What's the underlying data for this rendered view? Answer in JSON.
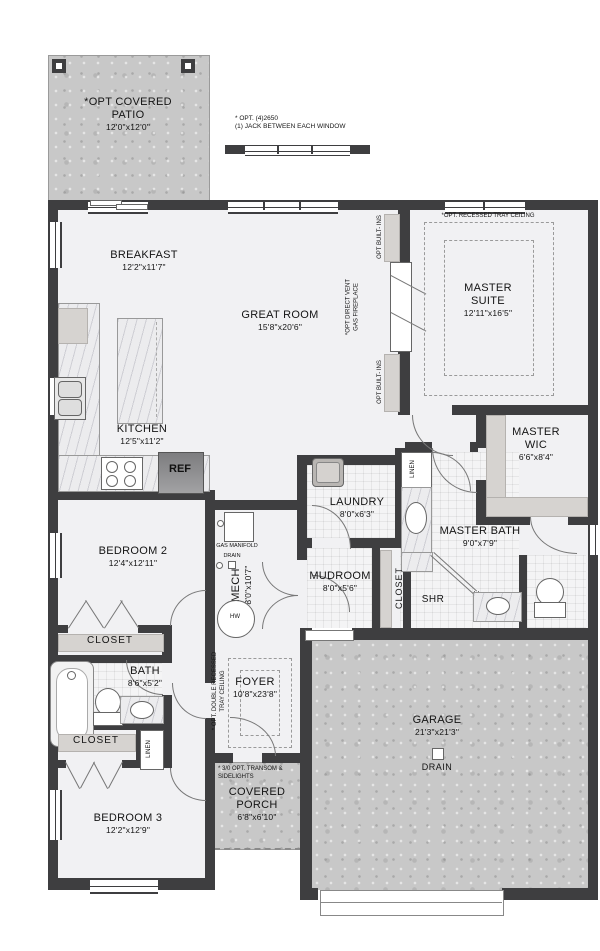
{
  "rooms": {
    "patio": {
      "name": "*OPT COVERED PATIO",
      "dims": "12'0\"x12'0\""
    },
    "breakfast": {
      "name": "BREAKFAST",
      "dims": "12'2\"x11'7\""
    },
    "great_room": {
      "name": "GREAT ROOM",
      "dims": "15'8\"x20'6\""
    },
    "master_suite": {
      "name": "MASTER SUITE",
      "dims": "12'11\"x16'5\""
    },
    "kitchen": {
      "name": "KITCHEN",
      "dims": "12'5\"x11'2\""
    },
    "master_wic": {
      "name": "MASTER WIC",
      "dims": "6'6\"x8'4\""
    },
    "laundry": {
      "name": "LAUNDRY",
      "dims": "8'0\"x6'3\""
    },
    "master_bath": {
      "name": "MASTER BATH",
      "dims": "9'0\"x7'9\""
    },
    "bedroom2": {
      "name": "BEDROOM 2",
      "dims": "12'4\"x12'11\""
    },
    "mech": {
      "name": "MECH",
      "dims": "8'0\"x10'7\""
    },
    "mudroom": {
      "name": "MUDROOM",
      "dims": "8'0\"x5'6\""
    },
    "bath": {
      "name": "BATH",
      "dims": "8'6\"x5'2\""
    },
    "foyer": {
      "name": "FOYER",
      "dims": "10'8\"x23'8\""
    },
    "bedroom3": {
      "name": "BEDROOM 3",
      "dims": "12'2\"x12'9\""
    },
    "covered_porch": {
      "name": "COVERED PORCH",
      "dims": "6'8\"x6'10\""
    },
    "garage": {
      "name": "GARAGE",
      "dims": "21'3\"x21'3\""
    }
  },
  "fixtures": {
    "ref": "REF",
    "shr": "SHR",
    "hw": "HW",
    "gas_manifold": "GAS MANIFOLD",
    "drain_mech": "DRAIN",
    "drain_garage": "DRAIN"
  },
  "closets": {
    "bed2": "CLOSET",
    "mud": "CLOSET",
    "hall": "CLOSET",
    "linen_hall": "LINEN",
    "linen_bath": "LINEN"
  },
  "notes": {
    "window_opt_line1": "* OPT. (4)2650",
    "window_opt_line2": "(1) JACK BETWEEN EACH WINDOW",
    "tray_ceiling": "*OPT. RECESSED TRAY CEILING",
    "foyer_tray_line1": "* OPT. DOUBLE RECESSED",
    "foyer_tray_line2": "TRAY CEILING",
    "fireplace_line1": "*OPT  DIRECT VENT",
    "fireplace_line2": "GAS FIREPLACE",
    "builtins_top": "OPT BUILT- INS",
    "builtins_bottom": "OPT BUILT- INS",
    "transom_line1": "* 3/0 OPT. TRANSOM &",
    "transom_line2": "SIDELIGHTS"
  },
  "colors": {
    "wall": "#3e3e40",
    "floor": "#f1f1f3",
    "concrete": "#c8c8c8"
  }
}
